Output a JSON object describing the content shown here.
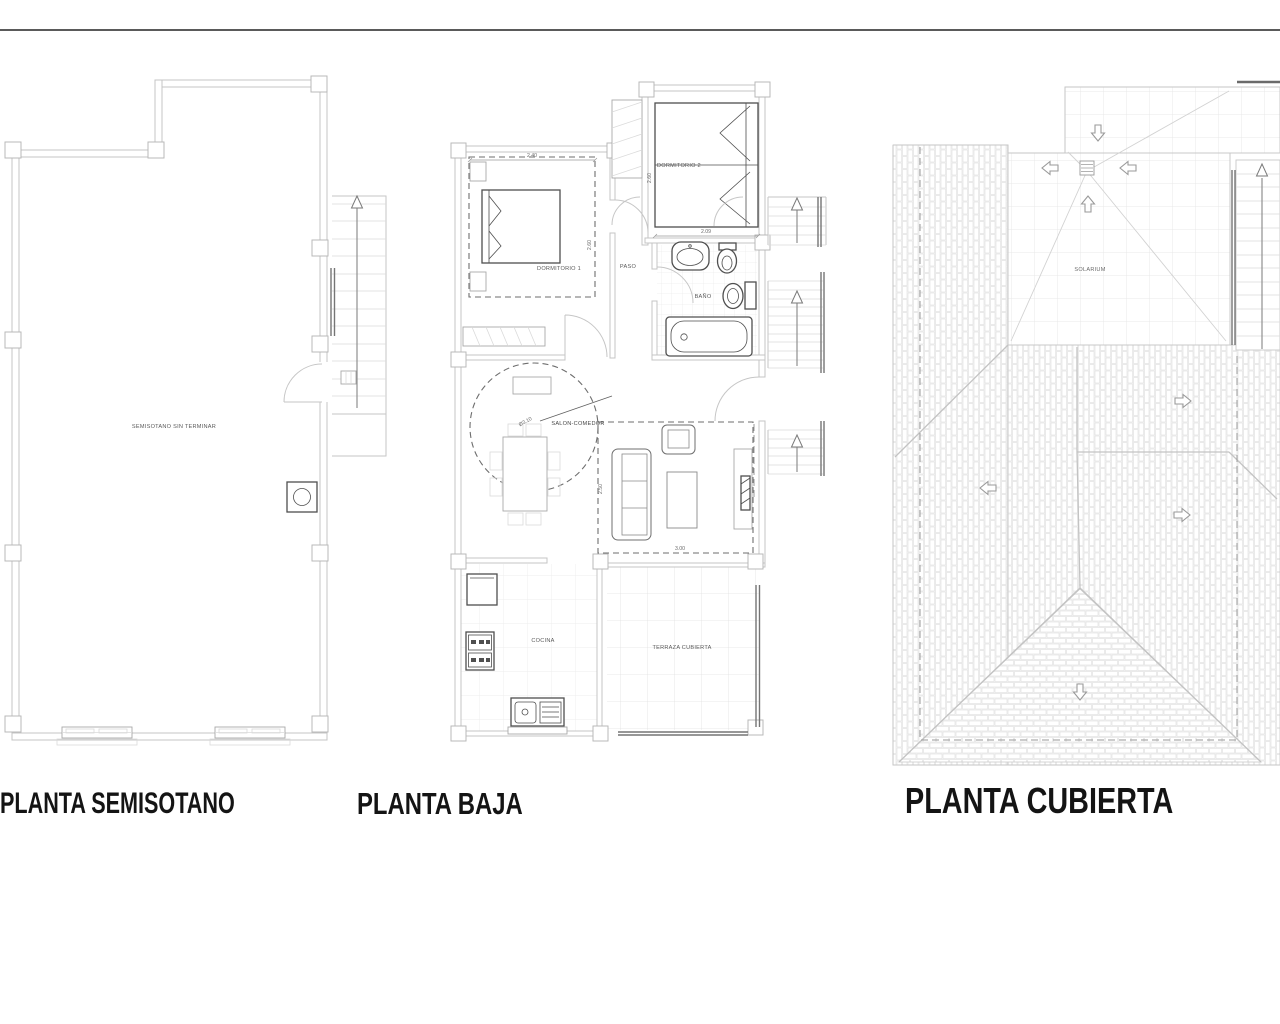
{
  "titles": {
    "semisotano": "PLANTA SEMISOTANO",
    "baja": "PLANTA BAJA",
    "cubierta": "PLANTA CUBIERTA"
  },
  "semisotano": {
    "room": "SEMISOTANO SIN TERMINAR"
  },
  "baja": {
    "rooms": {
      "dormitorio1": "DORMITORIO 1",
      "dormitorio2": "DORMITORIO 2",
      "paso": "PASO",
      "bano": "BAÑO",
      "salon_comedor": "SALON-COMEDOR",
      "cocina": "COCINA",
      "terraza": "TERRAZA CUBIERTA"
    },
    "dimensions": {
      "dorm1_width": "2.40",
      "dorm1_depth": "2.60",
      "dorm2_width": "2.09",
      "dorm2_depth": "2.60",
      "salon_circle_diameter": "Ø3.10",
      "salon_zone_depth": "2.50",
      "salon_zone_width": "3.00"
    }
  },
  "cubierta": {
    "room": "SOLARIUM"
  },
  "colors": {
    "wall_line": "#c4c4c4",
    "fixture_line": "#4f4f4f",
    "dashed_line": "#6e6e6e",
    "label_text": "#5a5a5a",
    "title_text": "#141414",
    "top_rule": "#5a5a5a"
  }
}
